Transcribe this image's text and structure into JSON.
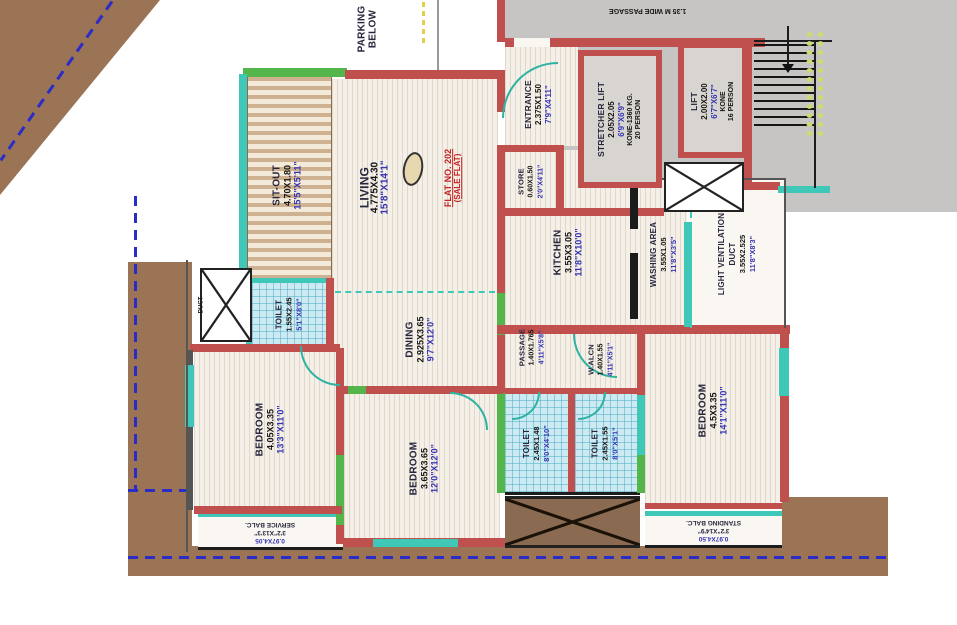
{
  "plan": {
    "flat": {
      "line1": "FLAT NO. 202",
      "line2": "(SALE FLAT)"
    },
    "parking": {
      "line1": "PARKING",
      "line2": "BELOW"
    },
    "passage_top": {
      "label": "1.35 M WIDE PASSAGE"
    },
    "rooms": {
      "sitout": {
        "name": "SIT-OUT",
        "dim_m": "4.70X1.80",
        "dim_ft": "15'5\"X5'11\""
      },
      "living": {
        "name": "LIVING",
        "dim_m": "4.775X4.30",
        "dim_ft": "15'8\"X14'1\""
      },
      "entrance": {
        "name": "ENTRANCE",
        "dim_m": "2.375X1.50",
        "dim_ft": "7'9\"X4'11\""
      },
      "stretcher_lift": {
        "name": "STRETCHER LIFT",
        "dim_m": "2.05X2.05",
        "dim_ft": "6'9\"X6'9\"",
        "make": "KONE-1360 KG.",
        "capacity": "20 PERSON"
      },
      "lift": {
        "name": "LIFT",
        "dim_m": "2.00X2.00",
        "dim_ft": "6'7\"X6'7\"",
        "make": "KONE",
        "capacity": "16 PERSON"
      },
      "store": {
        "name": "STORE",
        "dim_m": "0.60X1.50",
        "dim_ft": "2'0\"X4'11\""
      },
      "kitchen": {
        "name": "KITCHEN",
        "dim_m": "3.55X3.05",
        "dim_ft": "11'8\"X10'0\""
      },
      "washing": {
        "name": "WASHING AREA",
        "dim_m": "3.55X1.05",
        "dim_ft": "11'8\"X3'5\""
      },
      "light_duct": {
        "name1": "LIGHT VENTILATION",
        "name2": "DUCT",
        "dim_m": "3.55X2.525",
        "dim_ft": "11'8\"X8'3\""
      },
      "toilet_top": {
        "name": "TOILET",
        "dim_m": "1.55X2.45",
        "dim_ft": "5'1\"X8'0\""
      },
      "duct_small": {
        "name": "DUCT"
      },
      "dining": {
        "name": "DINING",
        "dim_m": "2.925X3.65",
        "dim_ft": "9'7\"X12'0\""
      },
      "passage": {
        "name": "PASSAGE",
        "dim_m": "1.40X1.765",
        "dim_ft": "4'11\"X5'8\""
      },
      "w_alcn": {
        "name": "W.ALCN",
        "dim_m": "1.40X1.55",
        "dim_ft": "4'11\"X5'1\""
      },
      "bedroom_left": {
        "name": "BEDROOM",
        "dim_m": "4.05X3.35",
        "dim_ft": "13'3\"X11'0\""
      },
      "bedroom_mid": {
        "name": "BEDROOM",
        "dim_m": "3.65X3.65",
        "dim_ft": "12'0\"X12'0\""
      },
      "bedroom_right": {
        "name": "BEDROOM",
        "dim_m": "4.5X3.35",
        "dim_ft": "14'1\"X11'0\""
      },
      "toilet_bl": {
        "name": "TOILET",
        "dim_m": "2.45X1.48",
        "dim_ft": "8'0\"X4'10\""
      },
      "toilet_br": {
        "name": "TOILET",
        "dim_m": "2.45X1.55",
        "dim_ft": "8'0\"X5'1\""
      },
      "service_balc": {
        "dim1": "0.97X4.05",
        "dim2": "3'2\"X13'3\"",
        "name": "SERVICE BALC."
      },
      "standing_balc": {
        "dim1": "0.97X4.50",
        "dim2": "3'2\"X14'9\"",
        "name": "STANDING BALC."
      }
    },
    "colors": {
      "wall_red": "#c0504d",
      "window_teal": "#3fc8b8",
      "wall_green": "#53b54a",
      "land_brown": "#9b7355",
      "boundary_blue": "#2a2cc8",
      "dim_blue": "#3434b4",
      "flat_red": "#c22222",
      "step_dot": "#ccdb72"
    }
  }
}
